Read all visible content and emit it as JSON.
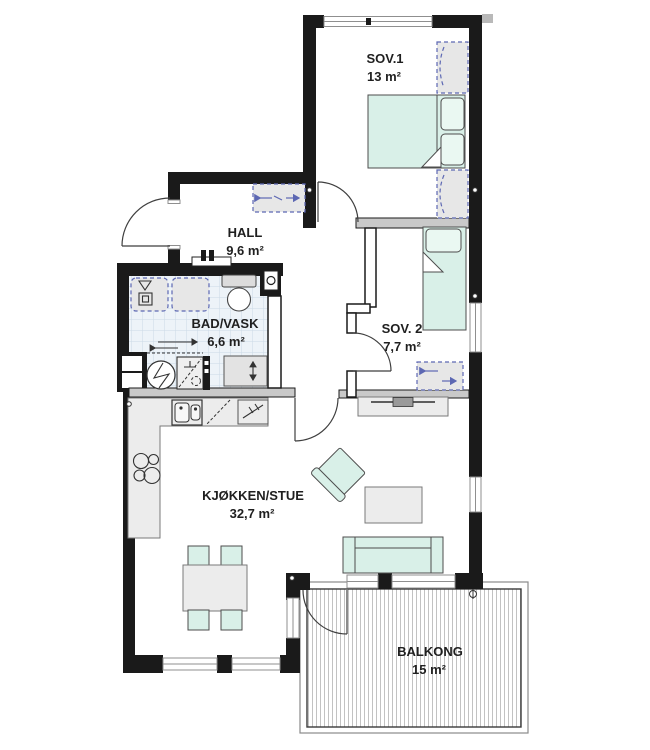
{
  "plan": {
    "rooms": [
      {
        "name": "SOV.1",
        "area": "13 m²"
      },
      {
        "name": "HALL",
        "area": "9,6 m²"
      },
      {
        "name": "BAD/VASK",
        "area": "6,6 m²"
      },
      {
        "name": "SOV. 2",
        "area": "7,7 m²"
      },
      {
        "name": "KJØKKEN/STUE",
        "area": "32,7 m²"
      },
      {
        "name": "BALKONG",
        "area": "15 m²"
      }
    ],
    "colors": {
      "wall": "#1a1a1a",
      "furniture": "#d9f0e8",
      "furniture_stroke": "#4d4d4d",
      "wardrobe_dash": "#5d68b3",
      "tile_floor": "#edf3f8",
      "label_text": "#1f1f1f"
    }
  }
}
